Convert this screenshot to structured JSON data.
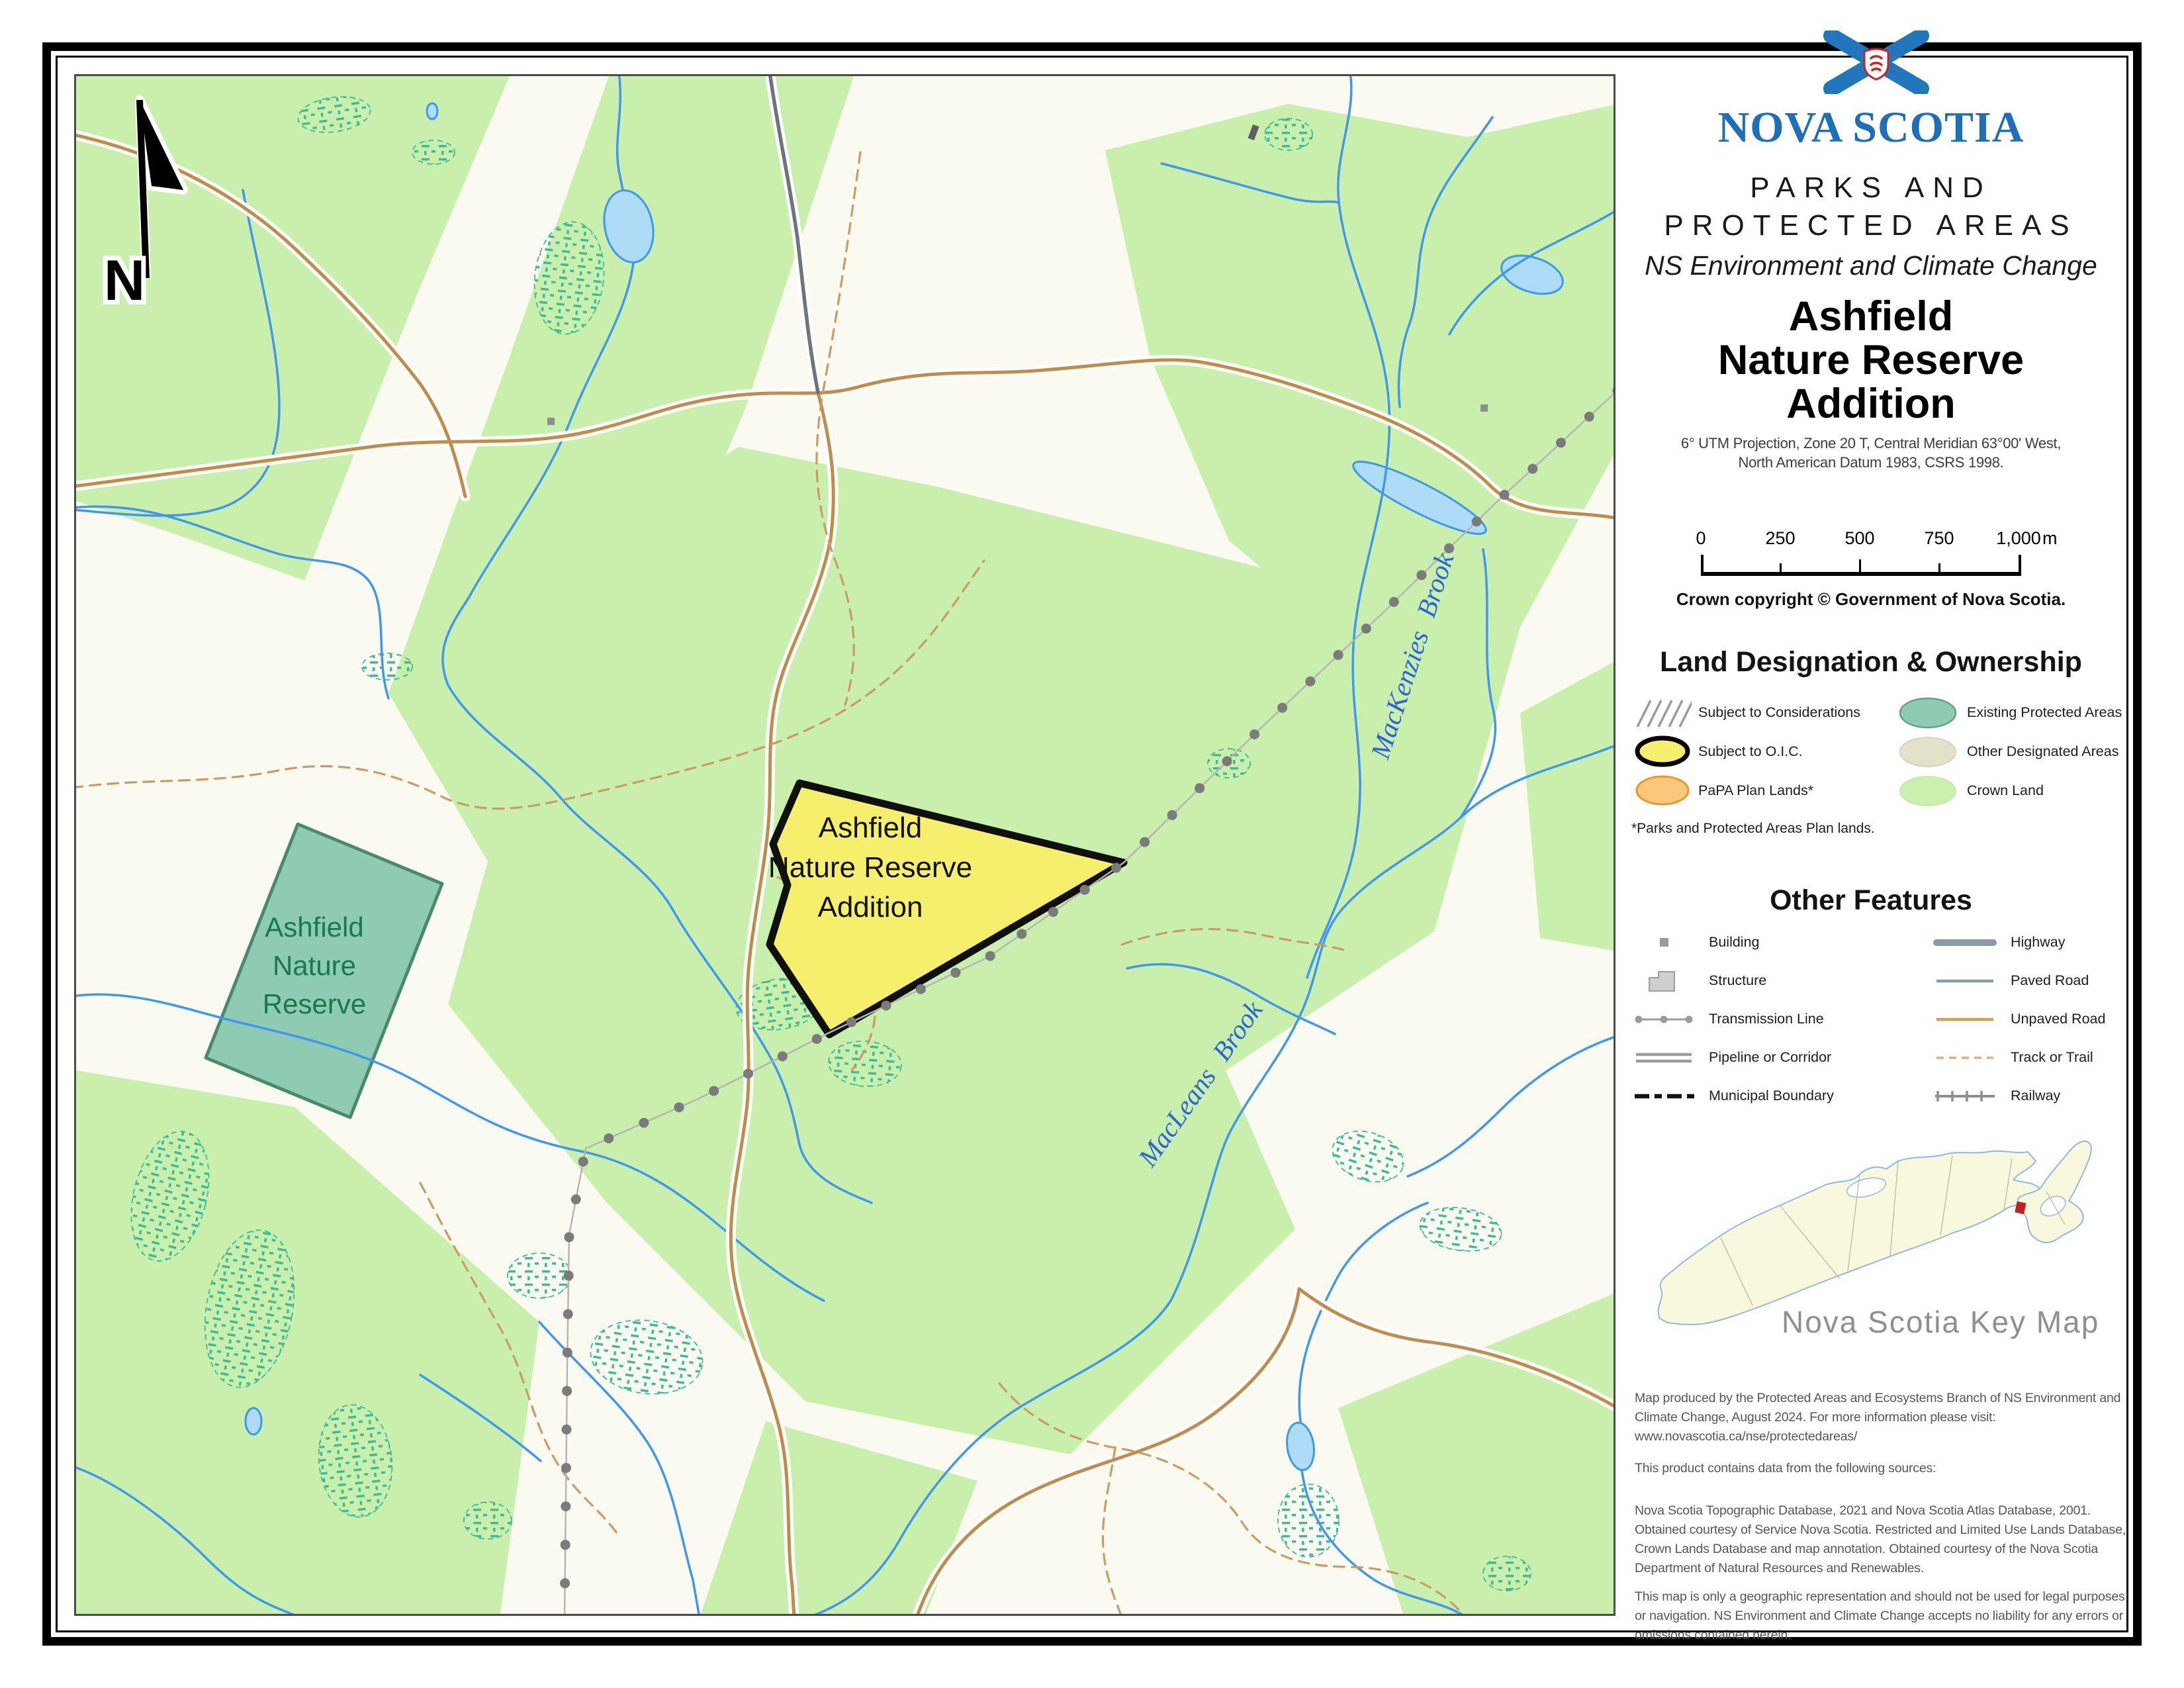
{
  "map": {
    "north_label": "N",
    "addition_label": {
      "line1": "Ashfield",
      "line2": "Nature Reserve",
      "line3": "Addition"
    },
    "reserve_label": {
      "line1": "Ashfield",
      "line2": "Nature",
      "line3": "Reserve"
    },
    "brooks": {
      "mackenzies": "MacKenzies Brook",
      "macleans": "MacLeans Brook"
    }
  },
  "sidebar": {
    "logo": {
      "wordmark": "NOVA SCOTIA",
      "flag_icon": "nova-scotia-flag"
    },
    "program_line1": "PARKS AND",
    "program_line2": "PROTECTED AREAS",
    "department": "NS Environment and Climate Change",
    "title": {
      "line1": "Ashfield",
      "line2": "Nature Reserve",
      "line3": "Addition"
    },
    "projection_line1": "6° UTM Projection, Zone 20 T, Central Meridian 63°00' West,",
    "projection_line2": "North American Datum 1983, CSRS 1998.",
    "scalebar": {
      "ticks": [
        "0",
        "250",
        "500",
        "750",
        "1,000"
      ],
      "unit": "m"
    },
    "copyright": "Crown copyright © Government of Nova Scotia.",
    "legend_land": {
      "title": "Land Designation & Ownership",
      "items_left": [
        {
          "symbol": "hatch-lines",
          "label": "Subject to Considerations"
        },
        {
          "symbol": "yellow-ellipse-black-outline",
          "label": "Subject to O.I.C."
        },
        {
          "symbol": "orange-ellipse",
          "label": "PaPA Plan Lands*"
        }
      ],
      "items_right": [
        {
          "symbol": "teal-ellipse",
          "label": "Existing Protected Areas"
        },
        {
          "symbol": "beige-ellipse",
          "label": "Other Designated Areas"
        },
        {
          "symbol": "green-ellipse",
          "label": "Crown Land"
        }
      ],
      "footnote": "*Parks and Protected Areas Plan lands."
    },
    "legend_features": {
      "title": "Other Features",
      "items_left": [
        {
          "symbol": "building-square",
          "label": "Building"
        },
        {
          "symbol": "structure-polygon",
          "label": "Structure"
        },
        {
          "symbol": "transmission-line",
          "label": "Transmission Line"
        },
        {
          "symbol": "pipeline-double-line",
          "label": "Pipeline or Corridor"
        },
        {
          "symbol": "municipal-boundary-dash",
          "label": "Municipal Boundary"
        }
      ],
      "items_right": [
        {
          "symbol": "highway-thick-line",
          "label": "Highway"
        },
        {
          "symbol": "paved-road-line",
          "label": "Paved Road"
        },
        {
          "symbol": "unpaved-road-line",
          "label": "Unpaved Road"
        },
        {
          "symbol": "track-trail-dashed",
          "label": "Track or Trail"
        },
        {
          "symbol": "railway-line",
          "label": "Railway"
        }
      ]
    },
    "keymap": {
      "label": "Nova Scotia Key Map",
      "marker": "red-location-marker"
    },
    "credits": [
      "Map produced by the Protected Areas and Ecosystems Branch of NS Environment and Climate Change, August 2024. For more information please visit: www.novascotia.ca/nse/protectedareas/",
      "This product contains data from the following sources:",
      "Nova Scotia Topographic Database, 2021 and Nova Scotia Atlas Database, 2001. Obtained courtesy of Service Nova Scotia. Restricted and Limited Use Lands Database, Crown Lands Database and map annotation. Obtained courtesy of the Nova Scotia Department of Natural Resources and Renewables.",
      "This map is only a geographic representation and should not be used for legal purposes or navigation. NS Environment and Climate Change accepts no liability for any errors or omissions contained herein."
    ]
  },
  "colors": {
    "crown_land": "#c9efad",
    "map_background": "#fafaf0",
    "addition_fill": "#f6ef6b",
    "addition_outline": "#101010",
    "reserve_fill": "#8fcbb2",
    "reserve_outline": "#49896c",
    "water_line": "#3f97f0",
    "lake_fill": "#aedcf7",
    "wetland": "#3dbb96",
    "unpaved_road": "#bf8c4a",
    "paved_road": "#6d747d",
    "trail": "#cf9a62",
    "transmission": "#7b7b7b",
    "ns_blue": "#1f6fb8",
    "papa_orange": "#f9c87c",
    "other_designated": "#e4e1ca",
    "keymap_land": "#f8f8dc",
    "keymap_coast": "#8fb9e0",
    "keymap_marker": "#c21f1f"
  }
}
